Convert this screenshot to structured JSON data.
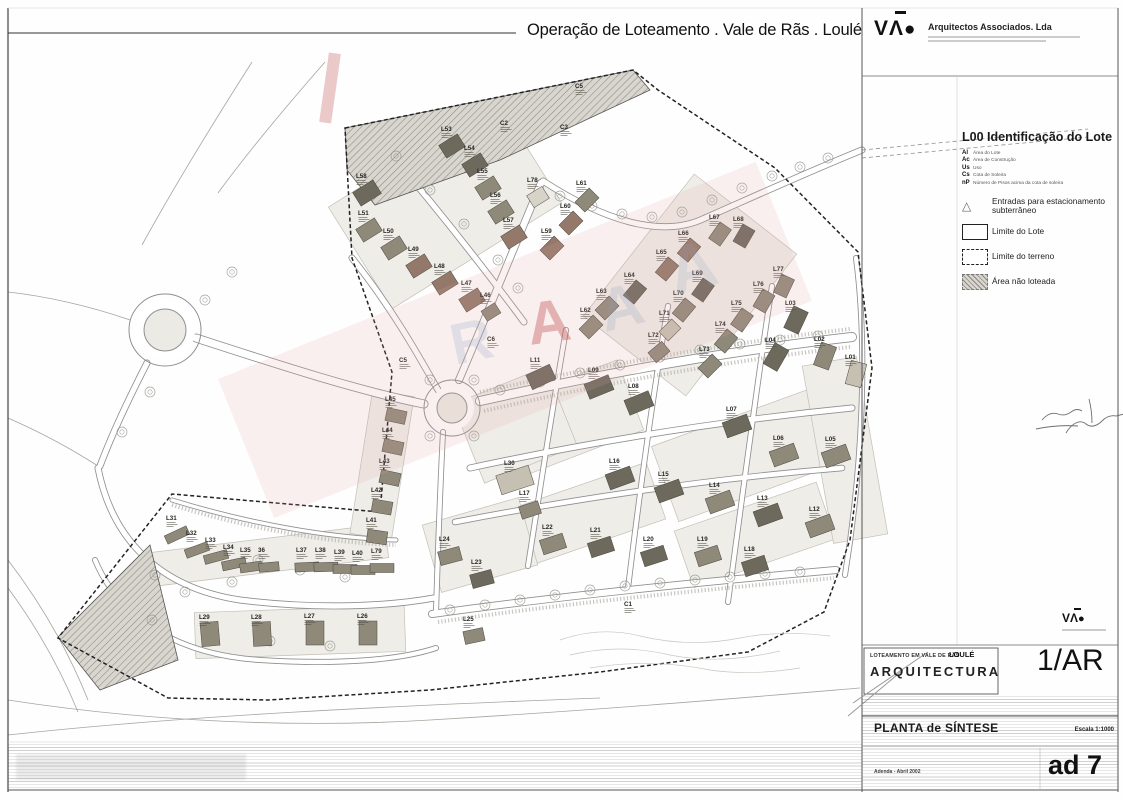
{
  "header": {
    "title": "Operação de Loteamento . Vale de Rãs . Loulé",
    "firm_name": "Arquitectos Associados. Lda",
    "firm_logo_letters": {
      "v": "V",
      "a": "Λ",
      "o": "●"
    }
  },
  "legend": {
    "title": "L00 Identificação do Lote",
    "abbreviations": [
      {
        "key": "Al",
        "label": "Área do Lote"
      },
      {
        "key": "Ac",
        "label": "Área de Construção"
      },
      {
        "key": "Us",
        "label": "Uso"
      },
      {
        "key": "Cs",
        "label": "Cota de Soleira"
      },
      {
        "key": "nP",
        "label": "Número de Pisos acima da cota de soleira"
      }
    ],
    "items": [
      {
        "symbol": "triangle",
        "label": "Entradas para estacionamento subterrâneo"
      },
      {
        "symbol": "solid-rect",
        "label": "Limite do Lote"
      },
      {
        "symbol": "dashed-rect",
        "label": "Limite do terreno"
      },
      {
        "symbol": "hatched-rect",
        "label": "Área não loteada"
      }
    ]
  },
  "title_block": {
    "project": "LOTEAMENTO EM VALE DE RÃS",
    "municipality": "LOULÉ",
    "discipline": "ARQUITECTURA",
    "sheet_code": "1/AR",
    "drawing_title": "PLANTA de SÍNTESE",
    "scale": "Escala 1:1000",
    "note": "Adenda - Abril 2002",
    "sheet_number": "ad 7"
  },
  "map": {
    "fills": {
      "d": "#6e695d",
      "m": "#8f897a",
      "b": "#94796a",
      "l": "#c6c0b2",
      "w": "#d8d3c8"
    },
    "watermark": {
      "pink": "#dfa3a3",
      "blue": "#8ea0bf",
      "red": "#c24e4e"
    },
    "lots": [
      [
        "L53",
        441,
        131,
        -32,
        22,
        15,
        "d"
      ],
      [
        "L54",
        464,
        150,
        -32,
        22,
        15,
        "d"
      ],
      [
        "L55",
        477,
        173,
        -32,
        22,
        15,
        "m"
      ],
      [
        "L56",
        490,
        197,
        -32,
        22,
        15,
        "m"
      ],
      [
        "L57",
        503,
        222,
        -32,
        22,
        15,
        "b"
      ],
      [
        "L58",
        356,
        178,
        -32,
        24,
        16,
        "d"
      ],
      [
        "L51",
        358,
        215,
        -32,
        22,
        15,
        "m"
      ],
      [
        "L50",
        383,
        233,
        -32,
        22,
        15,
        "m"
      ],
      [
        "L49",
        408,
        251,
        -32,
        22,
        15,
        "b"
      ],
      [
        "L48",
        434,
        268,
        -32,
        22,
        15,
        "b"
      ],
      [
        "L47",
        461,
        285,
        -32,
        22,
        15,
        "b"
      ],
      [
        "L46",
        480,
        297,
        -32,
        16,
        12,
        "m"
      ],
      [
        "C2",
        500,
        125,
        0,
        0,
        0,
        "n"
      ],
      [
        "C3",
        560,
        129,
        0,
        0,
        0,
        "n"
      ],
      [
        "C5",
        575,
        88,
        0,
        0,
        0,
        "n"
      ],
      [
        "L78",
        527,
        182,
        -32,
        18,
        14,
        "w"
      ],
      [
        "L61",
        576,
        185,
        -45,
        20,
        14,
        "m"
      ],
      [
        "L60",
        560,
        208,
        -45,
        20,
        14,
        "b"
      ],
      [
        "L59",
        541,
        233,
        -45,
        20,
        14,
        "b"
      ],
      [
        "L62",
        580,
        312,
        -45,
        20,
        14,
        "m"
      ],
      [
        "L63",
        596,
        293,
        -45,
        20,
        14,
        "m"
      ],
      [
        "L64",
        624,
        277,
        -50,
        20,
        14,
        "d"
      ],
      [
        "L65",
        656,
        254,
        -50,
        20,
        14,
        "b"
      ],
      [
        "L66",
        678,
        235,
        -50,
        20,
        14,
        "b"
      ],
      [
        "L67",
        709,
        219,
        -55,
        20,
        14,
        "m"
      ],
      [
        "L68",
        733,
        221,
        -60,
        20,
        14,
        "d"
      ],
      [
        "L69",
        692,
        275,
        -55,
        20,
        14,
        "d"
      ],
      [
        "L70",
        673,
        295,
        -50,
        20,
        14,
        "m"
      ],
      [
        "L71",
        659,
        315,
        -45,
        18,
        13,
        "l"
      ],
      [
        "L72",
        648,
        337,
        -40,
        18,
        13,
        "m"
      ],
      [
        "L73",
        699,
        351,
        -45,
        20,
        14,
        "m"
      ],
      [
        "L74",
        715,
        326,
        -50,
        20,
        14,
        "m"
      ],
      [
        "L75",
        731,
        305,
        -55,
        20,
        14,
        "m"
      ],
      [
        "L76",
        753,
        286,
        -60,
        20,
        14,
        "m"
      ],
      [
        "L77",
        773,
        271,
        -65,
        20,
        14,
        "m"
      ],
      [
        "L03",
        785,
        305,
        -65,
        24,
        16,
        "d"
      ],
      [
        "L04",
        765,
        342,
        -60,
        24,
        16,
        "d"
      ],
      [
        "L02",
        814,
        341,
        -70,
        24,
        16,
        "m"
      ],
      [
        "L01",
        845,
        359,
        -75,
        24,
        16,
        "l"
      ],
      [
        "L11",
        530,
        362,
        -25,
        26,
        16,
        "d"
      ],
      [
        "L09",
        588,
        372,
        -22,
        26,
        16,
        "d"
      ],
      [
        "L08",
        628,
        388,
        -22,
        26,
        16,
        "d"
      ],
      [
        "L07",
        726,
        411,
        -20,
        26,
        16,
        "d"
      ],
      [
        "L06",
        773,
        440,
        -20,
        26,
        16,
        "m"
      ],
      [
        "L05",
        825,
        441,
        -20,
        26,
        16,
        "m"
      ],
      [
        "L16",
        609,
        463,
        -20,
        26,
        16,
        "d"
      ],
      [
        "L15",
        658,
        476,
        -20,
        26,
        16,
        "d"
      ],
      [
        "L14",
        709,
        487,
        -20,
        26,
        16,
        "m"
      ],
      [
        "L13",
        757,
        500,
        -20,
        26,
        16,
        "d"
      ],
      [
        "L12",
        809,
        511,
        -20,
        26,
        16,
        "m"
      ],
      [
        "L22",
        542,
        529,
        -18,
        24,
        15,
        "m"
      ],
      [
        "L21",
        590,
        532,
        -18,
        24,
        15,
        "d"
      ],
      [
        "L20",
        643,
        541,
        -18,
        24,
        15,
        "d"
      ],
      [
        "L19",
        697,
        541,
        -18,
        24,
        15,
        "m"
      ],
      [
        "L18",
        744,
        551,
        -18,
        24,
        15,
        "d"
      ],
      [
        "L17",
        519,
        495,
        -18,
        20,
        13,
        "m"
      ],
      [
        "L30",
        504,
        465,
        -18,
        34,
        20,
        "l"
      ],
      [
        "L24",
        439,
        541,
        -15,
        22,
        14,
        "m"
      ],
      [
        "L23",
        471,
        564,
        -15,
        22,
        14,
        "d"
      ],
      [
        "L25",
        463,
        621,
        -12,
        20,
        13,
        "m"
      ],
      [
        "C1",
        624,
        606,
        0,
        0,
        0,
        "n"
      ],
      [
        "C6",
        487,
        341,
        0,
        0,
        0,
        "n"
      ],
      [
        "C5",
        399,
        362,
        0,
        0,
        0,
        "n"
      ],
      [
        "L31",
        166,
        520,
        -25,
        24,
        9,
        "m"
      ],
      [
        "L32",
        186,
        535,
        -20,
        24,
        9,
        "m"
      ],
      [
        "L33",
        205,
        542,
        -15,
        24,
        9,
        "m"
      ],
      [
        "L34",
        223,
        549,
        -12,
        24,
        9,
        "m"
      ],
      [
        "L35",
        240,
        552,
        -8,
        22,
        9,
        "m"
      ],
      [
        "36",
        258,
        552,
        -5,
        20,
        9,
        "m"
      ],
      [
        "L37",
        296,
        552,
        -3,
        24,
        9,
        "m"
      ],
      [
        "L38",
        315,
        552,
        -2,
        24,
        9,
        "m"
      ],
      [
        "L39",
        334,
        554,
        0,
        24,
        9,
        "m"
      ],
      [
        "L40",
        352,
        555,
        0,
        24,
        9,
        "m"
      ],
      [
        "L79",
        371,
        553,
        0,
        24,
        9,
        "m"
      ],
      [
        "L41",
        366,
        522,
        8,
        20,
        13,
        "m"
      ],
      [
        "L42",
        371,
        492,
        10,
        20,
        13,
        "m"
      ],
      [
        "L43",
        379,
        463,
        12,
        20,
        13,
        "m"
      ],
      [
        "L44",
        382,
        432,
        12,
        20,
        13,
        "m"
      ],
      [
        "L45",
        385,
        401,
        12,
        20,
        13,
        "m"
      ],
      [
        "L29",
        199,
        619,
        -5,
        18,
        24,
        "m"
      ],
      [
        "L28",
        251,
        619,
        -3,
        18,
        24,
        "m"
      ],
      [
        "L27",
        304,
        618,
        0,
        18,
        24,
        "m"
      ],
      [
        "L26",
        357,
        618,
        0,
        18,
        24,
        "m"
      ]
    ]
  }
}
